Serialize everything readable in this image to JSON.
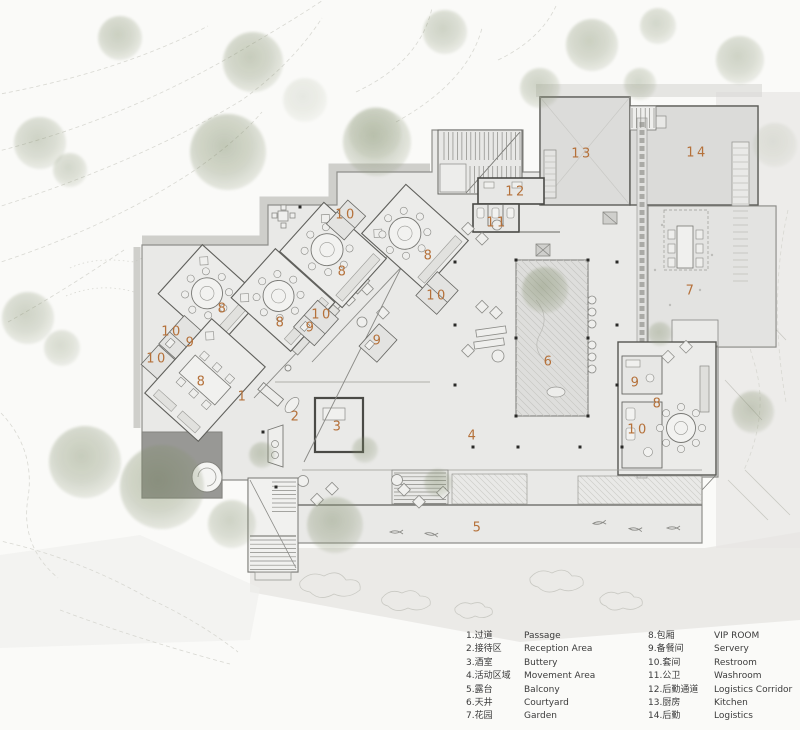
{
  "colors": {
    "label_accent": "#b5713a",
    "legend_text": "#3b3b3b",
    "tree_green": "#8c9a78",
    "building_fill": "#e9e9e7",
    "pool_gray": "#989895"
  },
  "plan": {
    "room_labels": [
      {
        "n": "1",
        "x": 243,
        "y": 397
      },
      {
        "n": "2",
        "x": 296,
        "y": 417
      },
      {
        "n": "3",
        "x": 338,
        "y": 427
      },
      {
        "n": "4",
        "x": 473,
        "y": 436
      },
      {
        "n": "5",
        "x": 478,
        "y": 528
      },
      {
        "n": "6",
        "x": 549,
        "y": 362
      },
      {
        "n": "7",
        "x": 691,
        "y": 291
      },
      {
        "n": "8",
        "x": 223,
        "y": 309
      },
      {
        "n": "8",
        "x": 281,
        "y": 323
      },
      {
        "n": "8",
        "x": 343,
        "y": 272
      },
      {
        "n": "8",
        "x": 429,
        "y": 256
      },
      {
        "n": "8",
        "x": 202,
        "y": 382
      },
      {
        "n": "8",
        "x": 658,
        "y": 404
      },
      {
        "n": "9",
        "x": 191,
        "y": 343
      },
      {
        "n": "9",
        "x": 311,
        "y": 328
      },
      {
        "n": "9",
        "x": 378,
        "y": 341
      },
      {
        "n": "9",
        "x": 636,
        "y": 383
      },
      {
        "n": "10",
        "x": 157,
        "y": 359
      },
      {
        "n": "10",
        "x": 172,
        "y": 332
      },
      {
        "n": "10",
        "x": 322,
        "y": 315
      },
      {
        "n": "10",
        "x": 346,
        "y": 215
      },
      {
        "n": "10",
        "x": 437,
        "y": 296
      },
      {
        "n": "10",
        "x": 638,
        "y": 430
      },
      {
        "n": "11",
        "x": 497,
        "y": 223
      },
      {
        "n": "12",
        "x": 516,
        "y": 192
      },
      {
        "n": "13",
        "x": 582,
        "y": 154
      },
      {
        "n": "14",
        "x": 697,
        "y": 153
      }
    ],
    "trees": [
      {
        "x": 120,
        "y": 38,
        "r": 22,
        "o": 0.55
      },
      {
        "x": 253,
        "y": 62,
        "r": 30,
        "o": 0.6
      },
      {
        "x": 305,
        "y": 100,
        "r": 22,
        "o": 0.22
      },
      {
        "x": 375,
        "y": 133,
        "r": 26,
        "o": 0.28
      },
      {
        "x": 445,
        "y": 32,
        "r": 22,
        "o": 0.5
      },
      {
        "x": 592,
        "y": 45,
        "r": 26,
        "o": 0.55
      },
      {
        "x": 658,
        "y": 26,
        "r": 18,
        "o": 0.45
      },
      {
        "x": 740,
        "y": 60,
        "r": 24,
        "o": 0.5
      },
      {
        "x": 775,
        "y": 145,
        "r": 22,
        "o": 0.22
      },
      {
        "x": 40,
        "y": 143,
        "r": 26,
        "o": 0.5
      },
      {
        "x": 70,
        "y": 170,
        "r": 17,
        "o": 0.45
      },
      {
        "x": 28,
        "y": 318,
        "r": 26,
        "o": 0.5
      },
      {
        "x": 62,
        "y": 348,
        "r": 18,
        "o": 0.4
      },
      {
        "x": 228,
        "y": 152,
        "r": 38,
        "o": 0.65
      },
      {
        "x": 377,
        "y": 142,
        "r": 34,
        "o": 0.6
      },
      {
        "x": 540,
        "y": 88,
        "r": 20,
        "o": 0.5
      },
      {
        "x": 640,
        "y": 84,
        "r": 16,
        "o": 0.45
      },
      {
        "x": 85,
        "y": 462,
        "r": 36,
        "o": 0.6
      },
      {
        "x": 162,
        "y": 487,
        "r": 42,
        "o": 0.65
      },
      {
        "x": 232,
        "y": 524,
        "r": 24,
        "o": 0.5
      },
      {
        "x": 335,
        "y": 525,
        "r": 28,
        "o": 0.6
      },
      {
        "x": 262,
        "y": 455,
        "r": 13,
        "o": 0.55
      },
      {
        "x": 438,
        "y": 483,
        "r": 14,
        "o": 0.5
      },
      {
        "x": 545,
        "y": 290,
        "r": 23,
        "o": 0.65
      },
      {
        "x": 660,
        "y": 334,
        "r": 12,
        "o": 0.5
      },
      {
        "x": 753,
        "y": 412,
        "r": 21,
        "o": 0.55
      },
      {
        "x": 365,
        "y": 450,
        "r": 13,
        "o": 0.5
      }
    ]
  },
  "legend": {
    "columns": [
      {
        "items": [
          {
            "num": "1",
            "zh": "过道",
            "en": "Passage"
          },
          {
            "num": "2",
            "zh": "接待区",
            "en": "Reception Area"
          },
          {
            "num": "3",
            "zh": "酒室",
            "en": "Buttery"
          },
          {
            "num": "4",
            "zh": "活动区域",
            "en": "Movement Area"
          },
          {
            "num": "5",
            "zh": "露台",
            "en": "Balcony"
          },
          {
            "num": "6",
            "zh": "天井",
            "en": "Courtyard"
          },
          {
            "num": "7",
            "zh": "花园",
            "en": "Garden"
          }
        ]
      },
      {
        "items": [
          {
            "num": "8",
            "zh": "包厢",
            "en": "VIP ROOM"
          },
          {
            "num": "9",
            "zh": "备餐间",
            "en": "Servery"
          },
          {
            "num": "10",
            "zh": "套间",
            "en": "Restroom"
          },
          {
            "num": "11",
            "zh": "公卫",
            "en": "Washroom"
          },
          {
            "num": "12",
            "zh": "后勤通道",
            "en": "Logistics Corridor"
          },
          {
            "num": "13",
            "zh": "厨房",
            "en": "Kitchen"
          },
          {
            "num": "14",
            "zh": "后勤",
            "en": "Logistics"
          }
        ]
      }
    ]
  }
}
